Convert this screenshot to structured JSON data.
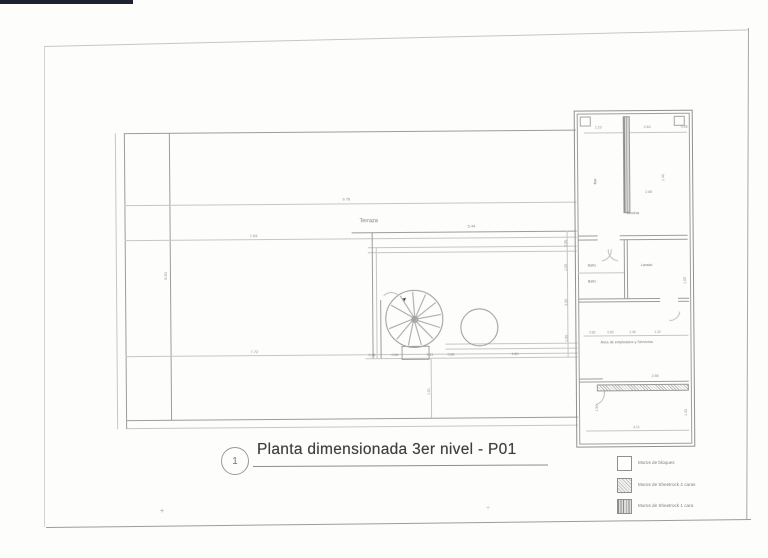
{
  "sheet": {
    "title_number": "1",
    "title": "Planta dimensionada 3er nivel - P01"
  },
  "legend": {
    "items": [
      {
        "id": "blocks",
        "label": "Muros de bloques"
      },
      {
        "id": "sheetrock2",
        "label": "Muros de Sheetrock 2 caras"
      },
      {
        "id": "sheetrock1",
        "label": "Muros de Sheetrock 1 cara"
      }
    ]
  },
  "colors": {
    "paper": "#fdfdfc",
    "ink_light": "#c6c6c6",
    "ink": "#9c9c9c",
    "ink_dark": "#878787",
    "title_ink": "#3f3f3f",
    "scanner_edge": "#1c2230"
  },
  "marks": {
    "plus": "+"
  },
  "stair": {
    "arrow": "➤"
  },
  "annotations": [
    {
      "kind": "room",
      "text": "Terraza",
      "x": 360,
      "y": 219,
      "s": 5.5,
      "r": 0
    },
    {
      "kind": "room",
      "text": "Cocina",
      "x": 627,
      "y": 213,
      "s": 4,
      "r": 0
    },
    {
      "kind": "room",
      "text": "Bar",
      "x": 594,
      "y": 186,
      "s": 4,
      "r": 90
    },
    {
      "kind": "room",
      "text": "Baño",
      "x": 588,
      "y": 266,
      "s": 3.5,
      "r": 0
    },
    {
      "kind": "room",
      "text": "Baño",
      "x": 588,
      "y": 282,
      "s": 3.5,
      "r": 0
    },
    {
      "kind": "room",
      "text": "Lavado",
      "x": 641,
      "y": 266,
      "s": 3.5,
      "r": 0
    },
    {
      "kind": "room",
      "text": "Área de empleados y Servicios",
      "x": 600,
      "y": 343,
      "s": 3.8,
      "r": 0
    },
    {
      "kind": "dim",
      "text": "9.78",
      "x": 343,
      "y": 197,
      "s": 4,
      "r": 0
    },
    {
      "kind": "dim",
      "text": "7.63",
      "x": 250,
      "y": 233,
      "s": 4,
      "r": 0
    },
    {
      "kind": "dim",
      "text": "7.72",
      "x": 250,
      "y": 349,
      "s": 4,
      "r": 0
    },
    {
      "kind": "dim",
      "text": "6.50",
      "x": 164,
      "y": 278,
      "s": 4,
      "r": 90
    },
    {
      "kind": "dim",
      "text": "5.44",
      "x": 468,
      "y": 225,
      "s": 4,
      "r": 0
    },
    {
      "kind": "dim",
      "text": "0.38",
      "x": 368,
      "y": 354,
      "s": 3.5,
      "r": 0
    },
    {
      "kind": "dim",
      "text": "0.86",
      "x": 391,
      "y": 354,
      "s": 3.5,
      "r": 0
    },
    {
      "kind": "dim",
      "text": "3.11",
      "x": 426,
      "y": 354,
      "s": 3.5,
      "r": 0
    },
    {
      "kind": "dim",
      "text": "0.88",
      "x": 447,
      "y": 354,
      "s": 3.5,
      "r": 0
    },
    {
      "kind": "dim",
      "text": "4.80",
      "x": 511,
      "y": 354,
      "s": 3.5,
      "r": 0
    },
    {
      "kind": "dim",
      "text": "1.61",
      "x": 427,
      "y": 395,
      "s": 3.5,
      "r": 90
    },
    {
      "kind": "dim",
      "text": "0.30",
      "x": 565,
      "y": 248,
      "s": 3.5,
      "r": 90
    },
    {
      "kind": "dim",
      "text": "1.05",
      "x": 565,
      "y": 272,
      "s": 3.5,
      "r": 90
    },
    {
      "kind": "dim",
      "text": "2.30",
      "x": 565,
      "y": 307,
      "s": 3.5,
      "r": 90
    },
    {
      "kind": "dim",
      "text": "1.90",
      "x": 565,
      "y": 343,
      "s": 3.5,
      "r": 90
    },
    {
      "kind": "dim",
      "text": "1.23",
      "x": 596,
      "y": 128,
      "s": 3.5,
      "r": 0
    },
    {
      "kind": "dim",
      "text": "2.64",
      "x": 645,
      "y": 128,
      "s": 3.5,
      "r": 0
    },
    {
      "kind": "dim",
      "text": "0.55",
      "x": 682,
      "y": 128,
      "s": 3.5,
      "r": 0
    },
    {
      "kind": "dim",
      "text": "2.65",
      "x": 646,
      "y": 193,
      "s": 3.5,
      "r": 0
    },
    {
      "kind": "dim",
      "text": "1.40",
      "x": 663,
      "y": 183,
      "s": 3.5,
      "r": 90
    },
    {
      "kind": "dim",
      "text": "1.05",
      "x": 684,
      "y": 286,
      "s": 3.5,
      "r": 90
    },
    {
      "kind": "dim",
      "text": "0.82",
      "x": 589,
      "y": 333,
      "s": 3.2,
      "r": 0
    },
    {
      "kind": "dim",
      "text": "0.60",
      "x": 607,
      "y": 333,
      "s": 3.2,
      "r": 0
    },
    {
      "kind": "dim",
      "text": "1.45",
      "x": 629,
      "y": 333,
      "s": 3.2,
      "r": 0
    },
    {
      "kind": "dim",
      "text": "1.10",
      "x": 654,
      "y": 333,
      "s": 3.2,
      "r": 0
    },
    {
      "kind": "dim",
      "text": "2.98",
      "x": 651,
      "y": 377,
      "s": 3.5,
      "r": 0
    },
    {
      "kind": "dim",
      "text": "4.11",
      "x": 632,
      "y": 428,
      "s": 3.5,
      "r": 0
    },
    {
      "kind": "dim",
      "text": "1.50",
      "x": 595,
      "y": 413,
      "s": 3.5,
      "r": 90
    },
    {
      "kind": "dim",
      "text": "1.92",
      "x": 684,
      "y": 418,
      "s": 3.5,
      "r": 90
    }
  ]
}
